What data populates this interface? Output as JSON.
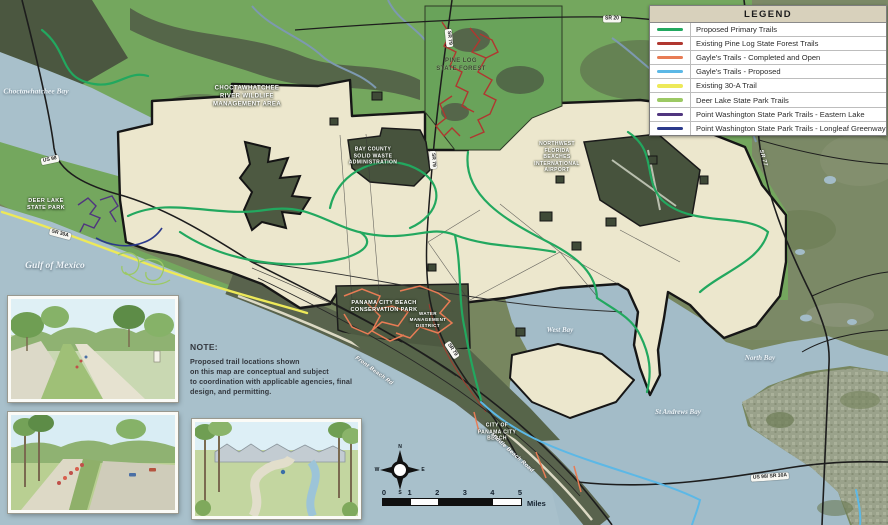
{
  "legend": {
    "title": "LEGEND",
    "items": [
      {
        "label": "Proposed Primary Trails",
        "color": "#22a85f"
      },
      {
        "label": "Existing Pine Log State Forest Trails",
        "color": "#b03730"
      },
      {
        "label": "Gayle's Trails - Completed and Open",
        "color": "#e87c55"
      },
      {
        "label": "Gayle's Trails - Proposed",
        "color": "#5cb8e6"
      },
      {
        "label": "Existing 30-A Trail",
        "color": "#ede959"
      },
      {
        "label": "Deer Lake State Park Trails",
        "color": "#9cc964"
      },
      {
        "label": "Point Washington State Park Trails - Eastern Lake",
        "color": "#50357f"
      },
      {
        "label": "Point Washington State Park Trails - Longleaf Greenway",
        "color": "#2c3a8b"
      }
    ]
  },
  "note": {
    "heading": "NOTE:",
    "lines": [
      "Proposed trail locations shown",
      "on this map are conceptual and subject",
      "to coordination with applicable agencies, final",
      "design, and permitting."
    ]
  },
  "water_labels": {
    "choctawhatchee_bay": "Choctawhatchee Bay",
    "gulf_of_mexico": "Gulf of Mexico",
    "west_bay": "West Bay",
    "north_bay": "North Bay",
    "st_andrews_bay": "St Andrews Bay"
  },
  "place_labels": {
    "wma": [
      "CHOCTAWHATCHEE",
      "RIVER WILDLIFE",
      "MANAGEMENT AREA"
    ],
    "pine_log": [
      "PINE LOG",
      "STATE FOREST"
    ],
    "solid_waste": [
      "BAY COUNTY",
      "SOLID WASTE",
      "ADMINISTRATION"
    ],
    "airport": [
      "NORTHWEST",
      "FLORIDA",
      "BEACHES",
      "INTERNATIONAL",
      "AIRPORT"
    ],
    "deer_lake": [
      "DEER LAKE",
      "STATE PARK"
    ],
    "conservation_park": [
      "PANAMA CITY BEACH",
      "CONSERVATION PARK"
    ],
    "water_mgmt": [
      "WATER",
      "MANAGEMENT",
      "DISTRICT"
    ],
    "pcb_city": [
      "CITY OF",
      "PANAMA CITY",
      "BEACH"
    ]
  },
  "road_labels": {
    "us98": "US 98",
    "sr79": "SR 79",
    "sr20": "SR 20",
    "sr77": "SR 77",
    "sr30a": "SR 30A",
    "us98_sr30a": "US 98/ SR 30A",
    "front_beach_rd": "Front Beach Rd",
    "middle_beach_rd": "Middle Beach Road"
  },
  "compass": {
    "n": "N",
    "e": "E",
    "s": "S",
    "w": "W"
  },
  "scale_bar": {
    "ticks": [
      "0",
      "1",
      "2",
      "3",
      "4",
      "5"
    ],
    "unit": "Miles"
  },
  "map_colors": {
    "water": "#a6bfca",
    "conservation_green": "#74a75e",
    "satellite_dark": "#4e5a43",
    "planning_area_cream": "#ece7cd",
    "boundary_black": "#161616",
    "urban": "#9aa28b"
  }
}
